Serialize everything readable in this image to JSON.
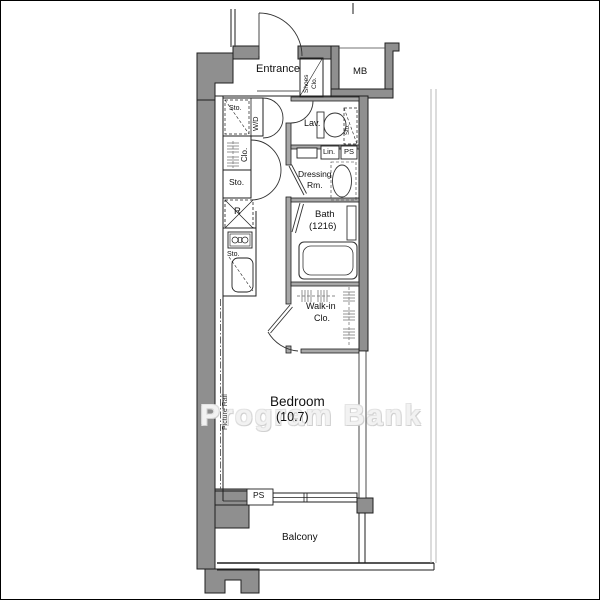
{
  "image": {
    "width": 600,
    "height": 600,
    "type": "apartment-floor-plan"
  },
  "colors": {
    "outer_wall": "#8f8f8f",
    "inner_wall": "#a8a8a8",
    "line": "#1f1f1f",
    "fixture_line": "#333333",
    "hanger": "#888888",
    "watermark": "#e8e8e8"
  },
  "floorplan": {
    "rooms": {
      "entrance": {
        "label": "Entrance"
      },
      "shoes_closet": {
        "line1": "Shoes",
        "line2": "Clo."
      },
      "meter_box": {
        "label": "MB"
      },
      "laundry": {
        "sto": "Sto.",
        "wd": "W/D"
      },
      "lavatory": {
        "label": "Lav.",
        "corner_sto": "Sto."
      },
      "linen": {
        "label": "Lin."
      },
      "pipe_space_upper": {
        "label": "PS"
      },
      "closet": {
        "label": "Clo."
      },
      "storage_left": {
        "label": "Sto."
      },
      "dressing_room": {
        "line1": "Dressing",
        "line2": "Rm."
      },
      "refrigerator_space": {
        "label": "R"
      },
      "kitchen_storage": {
        "label": "Sto."
      },
      "bath": {
        "line1": "Bath",
        "line2": "(1216)"
      },
      "walk_in_closet": {
        "line1": "Walk-in",
        "line2": "Clo."
      },
      "bedroom": {
        "line1": "Bedroom",
        "line2": "(10.7)"
      },
      "picture_rail": {
        "label": "Picture Rail"
      },
      "pipe_space_lower": {
        "label": "PS"
      },
      "balcony": {
        "label": "Balcony"
      }
    },
    "watermark": "Program Bank"
  }
}
